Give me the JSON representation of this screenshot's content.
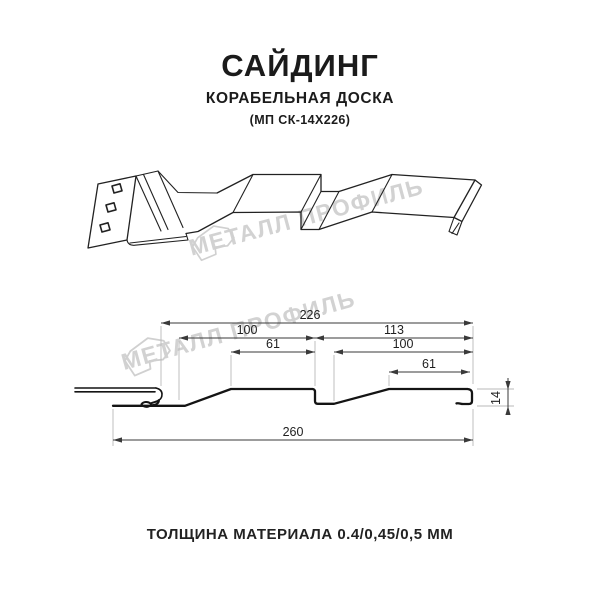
{
  "header": {
    "title": "САЙДИНГ",
    "subtitle": "КОРАБЕЛЬНАЯ ДОСКА",
    "code": "(МП СК-14Х226)"
  },
  "footer": {
    "text": "ТОЛЩИНА МАТЕРИАЛА 0.4/0,45/0,5 ММ"
  },
  "watermark": {
    "text": "МЕТАЛЛ ПРОФИЛЬ",
    "color": "#d2d2d2"
  },
  "dims": {
    "total": "226",
    "left_module": "100",
    "right_module": "113",
    "left_crest": "61",
    "right_inner": "100",
    "right_crest": "61",
    "overall": "260",
    "height": "14"
  }
}
